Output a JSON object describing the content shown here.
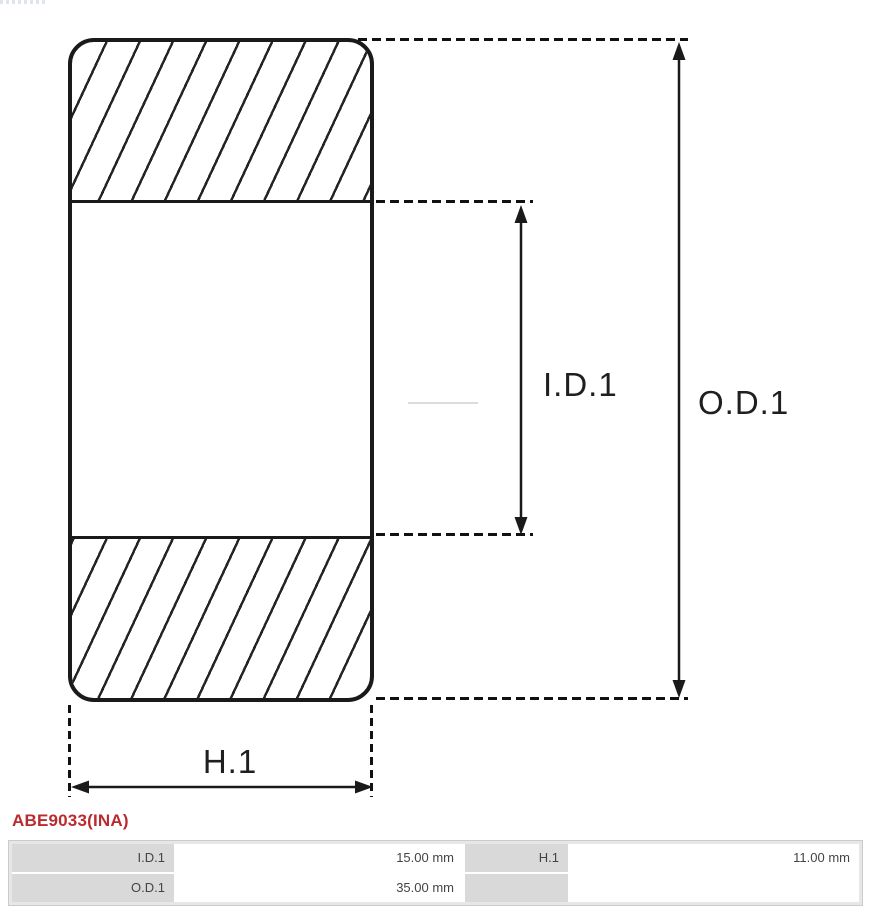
{
  "part_number": "ABE9033(INA)",
  "diagram": {
    "type": "bearing-cross-section",
    "id_label": "I.D.1",
    "od_label": "O.D.1",
    "h_label": "H.1"
  },
  "spec_table": {
    "rows": [
      {
        "cells": [
          {
            "label": "I.D.1",
            "value": "15.00 mm"
          },
          {
            "label": "H.1",
            "value": "11.00 mm"
          }
        ]
      },
      {
        "cells": [
          {
            "label": "O.D.1",
            "value": "35.00 mm"
          },
          {
            "label": "",
            "value": ""
          }
        ]
      }
    ]
  },
  "colors": {
    "accent_red": "#bb2a2e",
    "line": "#1a1a1a",
    "dash": "#111111",
    "hatch": "#242424",
    "table_label_bg": "#d9d9d9",
    "table_frame_bg": "#e7e7e7",
    "table_border": "#cbcbcb",
    "table_text": "#444444",
    "dim_label_text": "#1f1f1f"
  }
}
